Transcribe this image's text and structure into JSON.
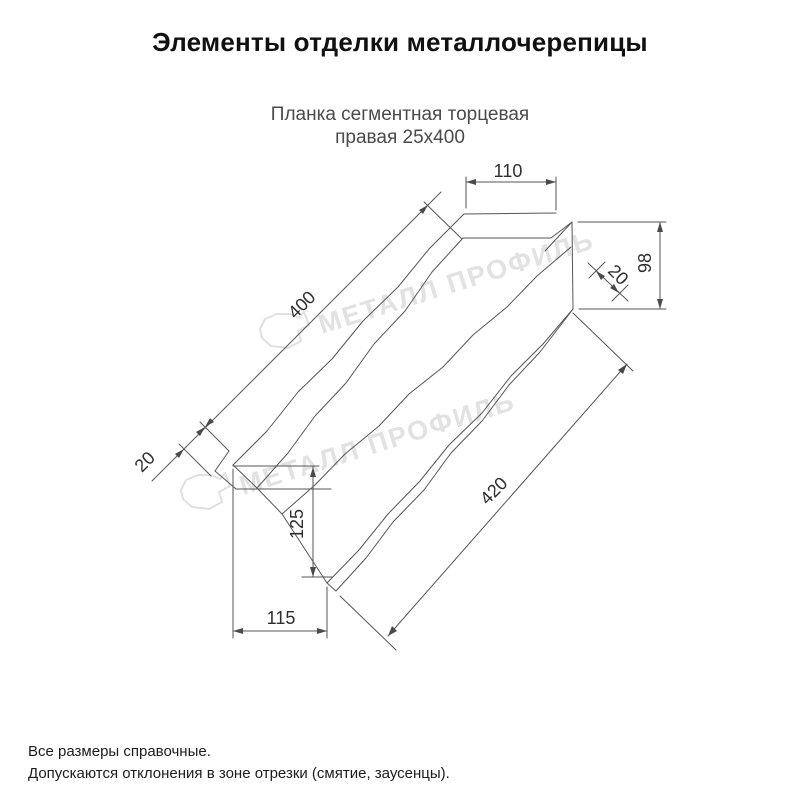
{
  "header": {
    "title": "Элементы отделки металлочерепицы",
    "subtitle_line1": "Планка сегментная торцевая",
    "subtitle_line2": "правая 25х400"
  },
  "drawing": {
    "type": "technical-drawing",
    "dims": {
      "top_segment_length": "110",
      "end_height": "98",
      "end_hem": "20",
      "top_length": "400",
      "bottom_length": "420",
      "left_hem": "20",
      "left_height": "125",
      "left_bottom_width": "115"
    }
  },
  "watermark": {
    "text": "МЕТАЛЛ ПРОФИЛЬ"
  },
  "footer": {
    "line1": "Все размеры справочные.",
    "line2": "Допускаются отклонения в зоне отрезки (смятие, заусенцы)."
  },
  "colors": {
    "line": "#565656",
    "dim_text": "#2e2e2e",
    "watermark": "#e2e2e2",
    "title_text": "#111111"
  }
}
